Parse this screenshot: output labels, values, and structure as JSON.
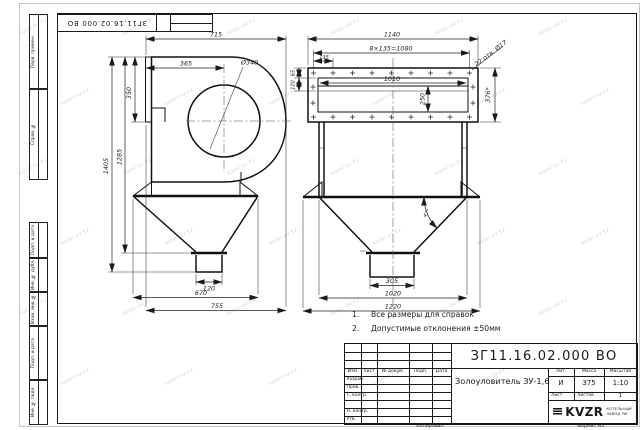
{
  "watermark": "kotel-kv.kz",
  "frame": {
    "corner_stamp": "ЗГ11.16.02.000 ВО",
    "left_labels": [
      "Перв. примен.",
      "Справ. №",
      "Подп. и дата",
      "Инв. № дубл.",
      "Взам. инв. №",
      "Подп. и дата",
      "Инв. № подл."
    ],
    "footer_copy": "Копировал",
    "footer_format": "Формат А3"
  },
  "views": {
    "side": {
      "dims": {
        "w715": "715",
        "w365": "365",
        "d340": "Ø340",
        "h350": "350",
        "h1405": "1405",
        "h1285": "1285",
        "w120": "120",
        "w670": "670",
        "w755": "755"
      }
    },
    "front": {
      "dims": {
        "w1140": "1140",
        "pitch": "8×135=1080",
        "w135": "135",
        "w1010": "1010",
        "h250": "250",
        "h65": "65",
        "h120": "120",
        "holes": "22 отв. Ø17",
        "h376": "376*",
        "angle": "47°",
        "w305": "305",
        "w1020": "1020",
        "w1220": "1220"
      }
    }
  },
  "notes": [
    {
      "num": "1.",
      "text": "Все размеры для справок"
    },
    {
      "num": "2.",
      "text": "Допустимые отклонения ±50мм"
    }
  ],
  "title_block": {
    "doc_number": "ЗГ11.16.02.000 ВО",
    "title": "Золоуловитель ЗУ-1,6",
    "header_cols": [
      "Изм.",
      "Лист",
      "№ докум.",
      "Подп.",
      "Дата"
    ],
    "rows": [
      "Разраб.",
      "Пров.",
      "Т. контр.",
      "Н. контр.",
      "Утв."
    ],
    "lit_label": "Лит.",
    "lit_value": "И",
    "mass_label": "Масса",
    "mass_value": "375",
    "scale_label": "Масштаб",
    "scale_value": "1:10",
    "sheet_label": "Лист",
    "sheets_label": "Листов",
    "sheets_value": "1",
    "logo_text": "KVZR",
    "logo_sub1": "КОТЕЛЬНЫЙ",
    "logo_sub2": "ЗАВОД РФ"
  }
}
